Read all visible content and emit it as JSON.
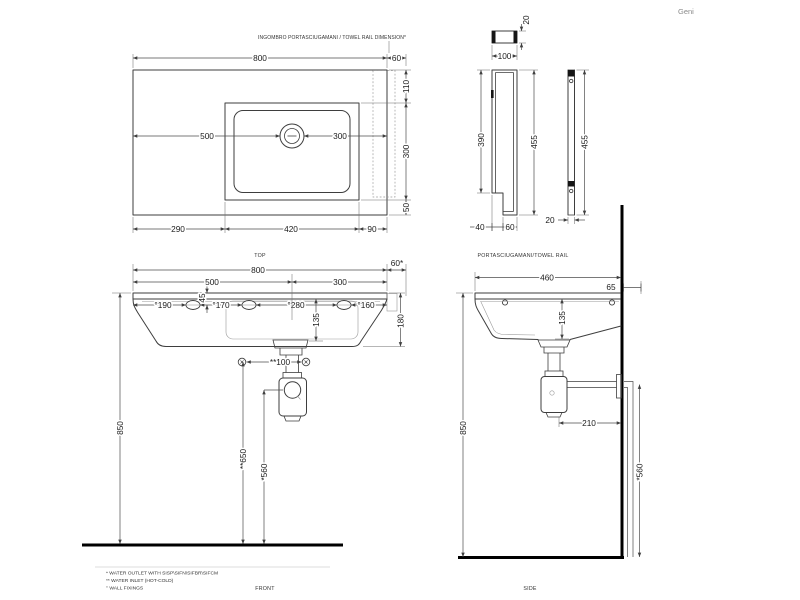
{
  "brand": "Geni",
  "top": {
    "note": "INGOMBRO PORTASCIUGAMANI / TOWEL RAIL DIMENSION*",
    "caption": "TOP",
    "dims": {
      "width": "800",
      "rail": "60",
      "back": "110",
      "side": "300",
      "front": "50",
      "left_to_drain": "500",
      "drain_to_right": "300",
      "left": "290",
      "basin": "420",
      "right": "90"
    }
  },
  "rail": {
    "caption": "PORTASCIUGAMANI/TOWEL RAIL",
    "dims": {
      "top_t": "20",
      "top_w": "100",
      "front_inner": "390",
      "front_h": "455",
      "foot_a": "40",
      "foot_b": "60",
      "side_h": "455",
      "side_t": "20"
    }
  },
  "front": {
    "caption": "FRONT",
    "dims": {
      "width": "800",
      "rail": "60*",
      "left_to_drain": "500",
      "drain_to_right": "300",
      "fix1": "°190",
      "fix2": "°170",
      "fix3": "°280",
      "fix4": "°160",
      "fix_drop": "45",
      "basin_depth": "135",
      "height": "180",
      "inlet_span": "**100",
      "fix_height": "850",
      "inlet_height": "**650",
      "outlet_height": "*560"
    }
  },
  "side": {
    "caption": "SIDE",
    "dims": {
      "depth": "460",
      "rail": "65",
      "basin_depth": "135",
      "trap_offset": "210",
      "fix_height": "850",
      "outlet_height": "*560"
    }
  },
  "footnotes": {
    "outlet": "* WATER OUTLET WITH SISP\\SIFN\\SIFBR\\SIFCM",
    "inlet": "** WATER INLET  (HOT-COLD)",
    "fixings": "° WALL FIXINGS"
  }
}
